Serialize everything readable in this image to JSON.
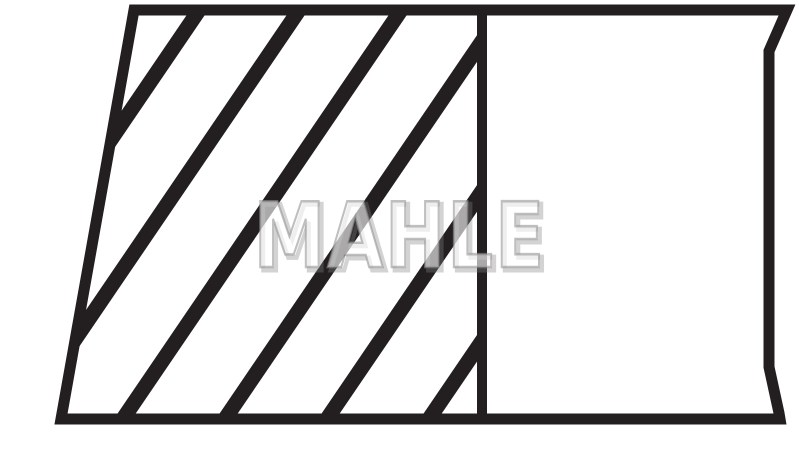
{
  "figure": {
    "ink_color": "#231f20",
    "background_color": "#ffffff"
  },
  "watermark": {
    "text": "MAHLE",
    "fill_color": "rgba(255,255,255,0.62)",
    "stroke_color": "rgba(148,148,148,0.60)",
    "shadow_color": "rgba(130,130,130,0.35)"
  }
}
